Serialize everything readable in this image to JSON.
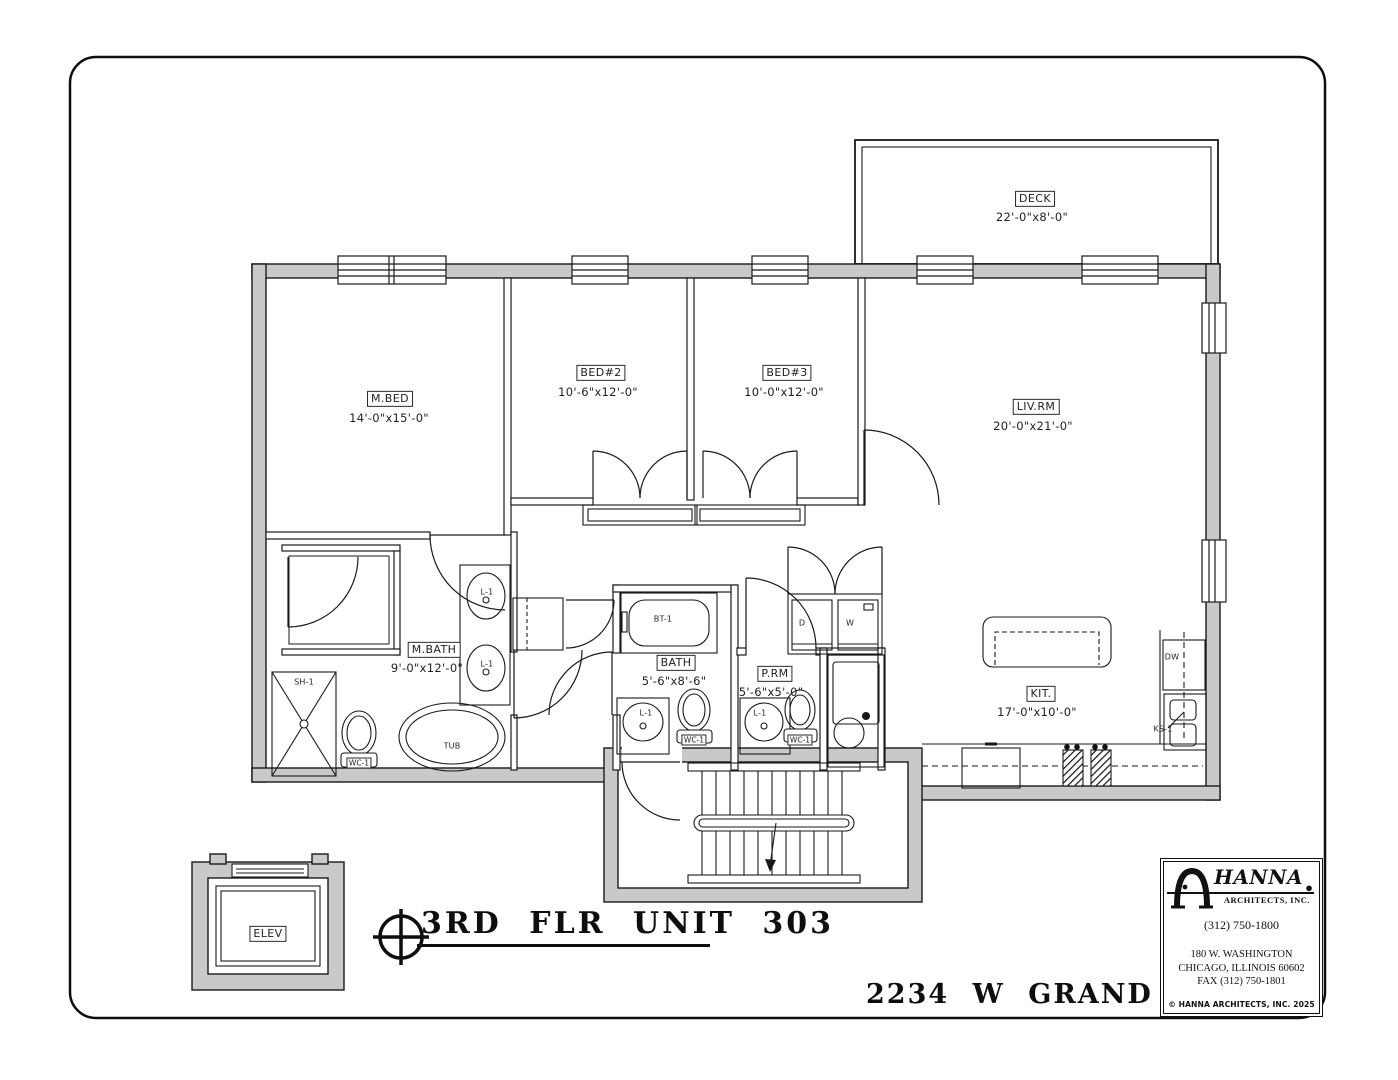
{
  "sheet": {
    "title": "3RD FLR UNIT 303",
    "address": "2234 W GRAND AVE"
  },
  "rooms": {
    "deck": {
      "name": "DECK",
      "dims": "22'-0\"x8'-0\""
    },
    "mbed": {
      "name": "M.BED",
      "dims": "14'-0\"x15'-0\""
    },
    "bed2": {
      "name": "BED#2",
      "dims": "10'-6\"x12'-0\""
    },
    "bed3": {
      "name": "BED#3",
      "dims": "10'-0\"x12'-0\""
    },
    "livrm": {
      "name": "LIV.RM",
      "dims": "20'-0\"x21'-0\""
    },
    "mbath": {
      "name": "M.BATH",
      "dims": "9'-0\"x12'-0\""
    },
    "bath": {
      "name": "BATH",
      "dims": "5'-6\"x8'-6\""
    },
    "prm": {
      "name": "P.RM",
      "dims": "5'-6\"x5'-0\""
    },
    "kit": {
      "name": "KIT.",
      "dims": "17'-0\"x10'-0\""
    },
    "elev": {
      "name": "ELEV"
    }
  },
  "fixtures": {
    "shower": "SH-1",
    "toilet": "WC-1",
    "tub": "TUB",
    "lav": "L-1",
    "bathtub": "BT-1",
    "dryer": "D",
    "washer": "W",
    "dishwasher": "DW",
    "kitchen_sink": "KS-1"
  },
  "title_block": {
    "firm_name": "HANNA",
    "firm_sub": "ARCHITECTS, INC.",
    "firm_dot": "●",
    "phone": "(312) 750-1800",
    "address1": "180 W. WASHINGTON",
    "address2": "CHICAGO, ILLINOIS 60602",
    "fax": "FAX (312) 750-1801",
    "copyright": "© HANNA ARCHITECTS, INC. 2025"
  },
  "colors": {
    "wall_fill": "#c9c9c9",
    "line": "#1a1a1a",
    "paper": "#ffffff"
  }
}
